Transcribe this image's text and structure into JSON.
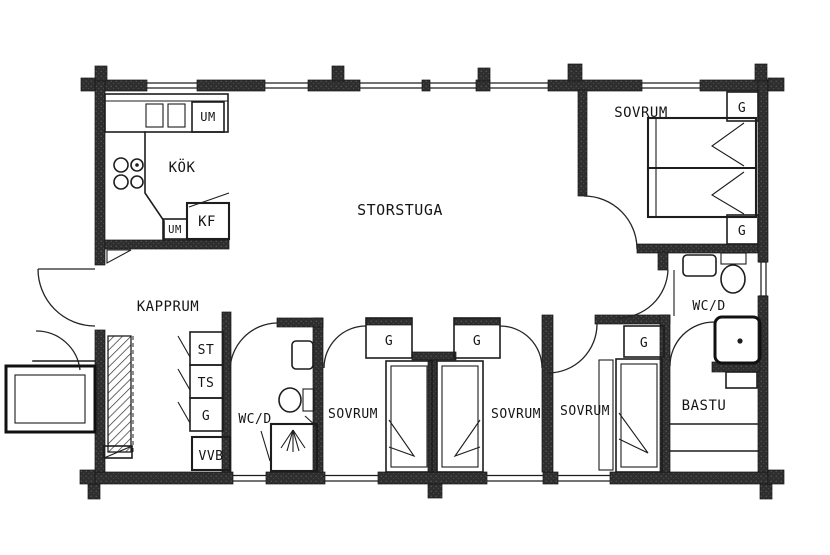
{
  "rooms": {
    "kitchen": {
      "label": "KÖK"
    },
    "living": {
      "label": "STORSTUGA"
    },
    "bedroom_master": {
      "label": "SOVRUM"
    },
    "bedroom_left": {
      "label": "SOVRUM"
    },
    "bedroom_mid": {
      "label": "SOVRUM"
    },
    "bedroom_right": {
      "label": "SOVRUM"
    },
    "entry": {
      "label": "KAPPRUM"
    },
    "bath_top": {
      "label": "WC/D"
    },
    "bath_bottom": {
      "label": "WC/D"
    },
    "sauna": {
      "label": "BASTU"
    }
  },
  "fixtures": {
    "um_top": {
      "label": "UM"
    },
    "um_bottom": {
      "label": "UM"
    },
    "fridge": {
      "label": "KF"
    },
    "closet_st": {
      "label": "ST"
    },
    "closet_ts": {
      "label": "TS"
    },
    "closet_g": {
      "label": "G"
    },
    "water_heater": {
      "label": "VVB"
    },
    "wardrobe": {
      "label": "G"
    }
  },
  "colors": {
    "line": "#1d1d1d",
    "wall": "#2e2e2e",
    "background": "#ffffff"
  }
}
